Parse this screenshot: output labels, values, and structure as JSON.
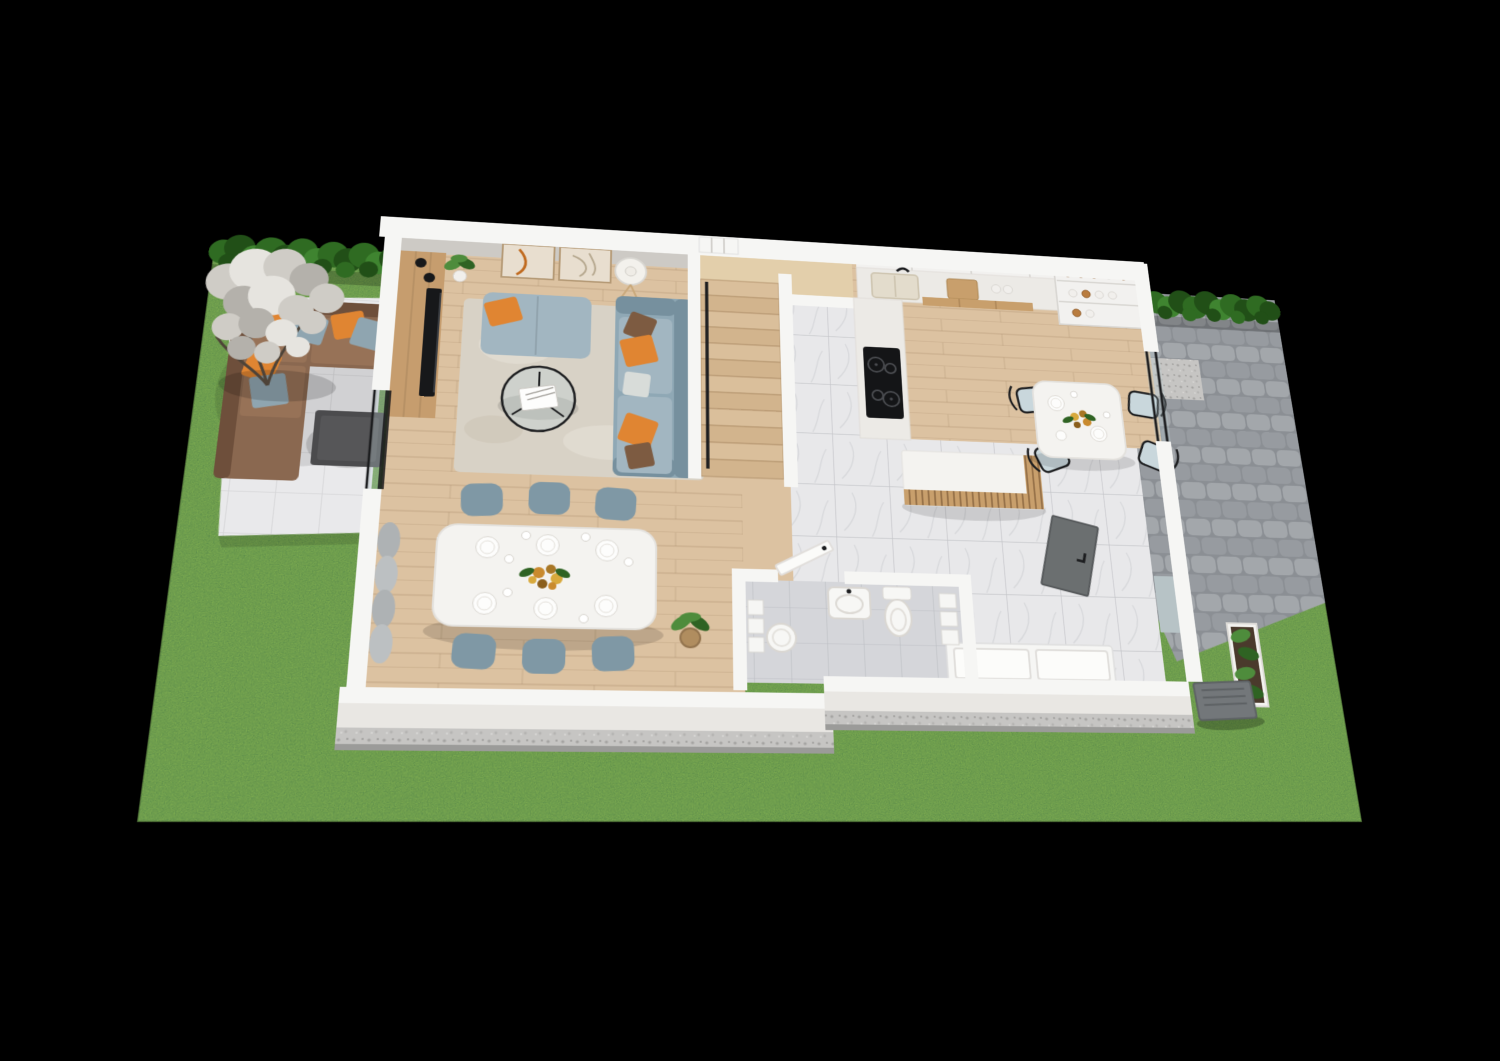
{
  "scene": {
    "label": "3D isometric floor plan of a single-story house with garden, patios, living room, dining area, staircase, kitchen, breakfast nook, hallway and bathroom",
    "type": "architectural-3d-floor-plan",
    "rooms": [
      "living-room",
      "dining-area",
      "staircase",
      "hallway",
      "kitchen",
      "breakfast-nook",
      "bathroom"
    ],
    "outdoor": [
      "garden-lawn",
      "boxwood-hedge",
      "blossom-tree",
      "tiled-patio",
      "outdoor-corner-sofa",
      "outdoor-coffee-table",
      "paver-driveway",
      "gravel-border",
      "garden-planter",
      "ac-unit"
    ],
    "counts": {
      "dining_chairs": 6,
      "breakfast_chairs": 4,
      "stair_treads": 12,
      "wall_art_frames": 2
    }
  },
  "colors": {
    "background": "#000000",
    "lawn": "#7cab50",
    "lawnShade": "#639140",
    "hedge": "#2f6b22",
    "hedgeDark": "#214f17",
    "hedgeLight": "#3f8430",
    "blossom": "#cfccc6",
    "blossomDark": "#b4b1ab",
    "blossomLight": "#e6e4df",
    "branch": "#4e4338",
    "patioTile": "#e9e9eb",
    "patioGrout": "#d5d5d8",
    "outdoorSofa": "#8a6850",
    "outdoorSofaDark": "#6e4f3b",
    "outdoorCushion": "#977257",
    "pillowOrange": "#e08532",
    "pillowOrangeDark": "#c06a1f",
    "pillowBlue": "#8fa5b0",
    "pillowBrown": "#7d5b41",
    "pillowPattern": "#d8dcd9",
    "tableDark": "#4b4b4d",
    "wallWhite": "#f6f6f4",
    "wallFace": "#cdcac5",
    "wallFront": "#e9e7e3",
    "woodFloor": "#dcc2a1",
    "woodLine": "#8b6b4a",
    "mediaWood": "#c69d6e",
    "tvBlack": "#17181a",
    "rug": "#d8d2c6",
    "rugLight": "#e6e1d7",
    "sofaBlue": "#8fa8b5",
    "sofaBlueLight": "#a2b6c1",
    "sofaBlueDark": "#76909e",
    "tableWhite": "#f4f3f0",
    "chairBlue": "#7f98a5",
    "chairWood": "#c9a87a",
    "stairWood": "#dabf9b",
    "stairWoodAlt": "#d2b48d",
    "treadEdge": "#b3946e",
    "landingWood": "#e3cfab",
    "marble": "#e8e8ea",
    "marbleLine": "#c3c4c8",
    "bathTile": "#d5d6da",
    "bathTileLine": "#bdbfc4",
    "counter": "#eceae6",
    "cabinet": "#f2f1ef",
    "cabinetLine": "#d9d7d3",
    "drawerWood": "#c89f6c",
    "cooktop": "#141517",
    "burner": "#4a4c50",
    "jarLid": "#b97c3e",
    "ceramicWhite": "#f1efec",
    "fixture": "#f7f7f5",
    "doorGray": "#6b6f70",
    "paver": "#a3a7ab",
    "paverAlt": "#979ba0",
    "paverGap": "#8b8f94",
    "gravel": "#c6c5c3",
    "gravelDark": "#a5a4a2",
    "plinth": "#9b9b99",
    "acUnit": "#73777a",
    "plant": "#4e8c3c",
    "plantDark": "#2f6323",
    "basket": "#b08d5f",
    "curtain": "#aeb2b4",
    "glass": "#bcd2d8",
    "frameBlack": "#1c1d1f",
    "lampWhite": "#f3f1ec",
    "artBeige": "#e8decf",
    "artFrame": "#b59a76"
  }
}
